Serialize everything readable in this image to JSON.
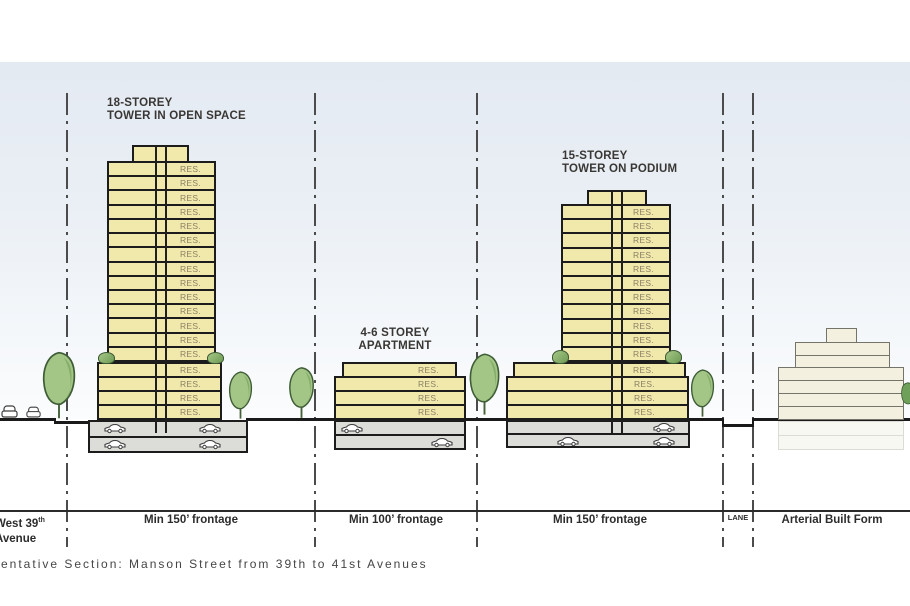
{
  "caption": "entative Section: Manson Street from 39th to 41st Avenues",
  "annotations": {
    "left_tower": {
      "line1": "18-STOREY",
      "line2": "TOWER IN OPEN SPACE"
    },
    "mid_building": {
      "line1": "4-6 STOREY",
      "line2": "APARTMENT"
    },
    "right_tower": {
      "line1": "15-STOREY",
      "line2": "TOWER ON PODIUM"
    }
  },
  "buildings": {
    "left_tower": {
      "tower_floors": [
        "RES.",
        "RES.",
        "RES.",
        "RES.",
        "RES.",
        "RES.",
        "RES.",
        "RES.",
        "RES.",
        "RES.",
        "RES.",
        "RES.",
        "RES.",
        "RES."
      ],
      "podium_floors": [
        "RES.",
        "RES.",
        "RES.",
        "RES."
      ]
    },
    "mid_building": {
      "top_floors": [
        "RES."
      ],
      "lower_floors": [
        "RES.",
        "RES.",
        "RES."
      ]
    },
    "right_tower": {
      "tower_floors": [
        "RES.",
        "RES.",
        "RES.",
        "RES.",
        "RES.",
        "RES.",
        "RES.",
        "RES.",
        "RES.",
        "RES.",
        "RES."
      ],
      "podium_upper_floors": [
        "RES."
      ],
      "podium_lower_floors": [
        "RES.",
        "RES.",
        "RES."
      ]
    }
  },
  "dimensions": {
    "street": {
      "prefix": "West 39",
      "sup": "th",
      "line2": "Avenue"
    },
    "frontage_left": "Min 150’ frontage",
    "frontage_mid": "Min 100’ frontage",
    "frontage_right": "Min 150’ frontage",
    "lane": "LANE",
    "arterial": "Arterial Built Form"
  },
  "colors": {
    "floor_fill": "#f1e8ab",
    "outline": "#1c1c1c",
    "res_text": "#8a8166",
    "parking_fill": "#dcddd8",
    "sky_top": "#e4eaf2",
    "tree_green": "#a3c585",
    "arterial_fill": "#f3f0e0"
  }
}
